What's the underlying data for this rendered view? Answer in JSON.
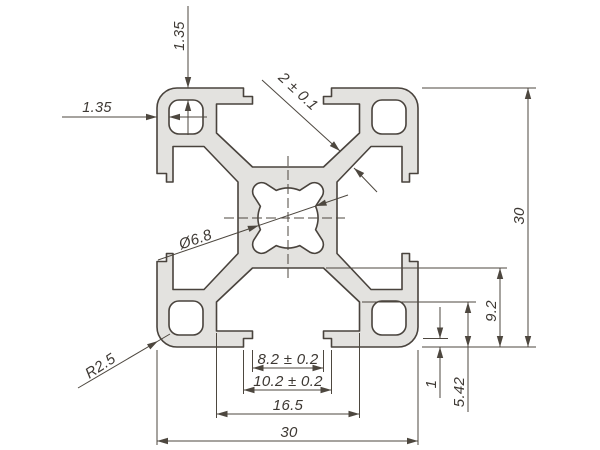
{
  "drawing": {
    "kind": "technical cross-section drawing",
    "subject": "30x30 T-slot aluminium extrusion profile",
    "units": "mm"
  },
  "dims": {
    "top_wall": "1.35",
    "left_wall": "1.35",
    "web_thickness": "2 ± 0.1",
    "center_bore": "Ø6.8",
    "corner_radius": "R2.5",
    "overall_height": "30",
    "slot_back_depth": "9.2",
    "slot_cavity_depth": "5.42",
    "lip_step_depth": "1",
    "slot_opening_width": "8.2 ± 0.2",
    "slot_step_width": "10.2 ± 0.2",
    "slot_channel_width": "16.5",
    "overall_width": "30"
  },
  "colors": {
    "background": "#ffffff",
    "profile_fill": "#e3e2df",
    "outline": "#49433d",
    "dimension_lines": "#4d473f",
    "text": "#3d3833"
  }
}
